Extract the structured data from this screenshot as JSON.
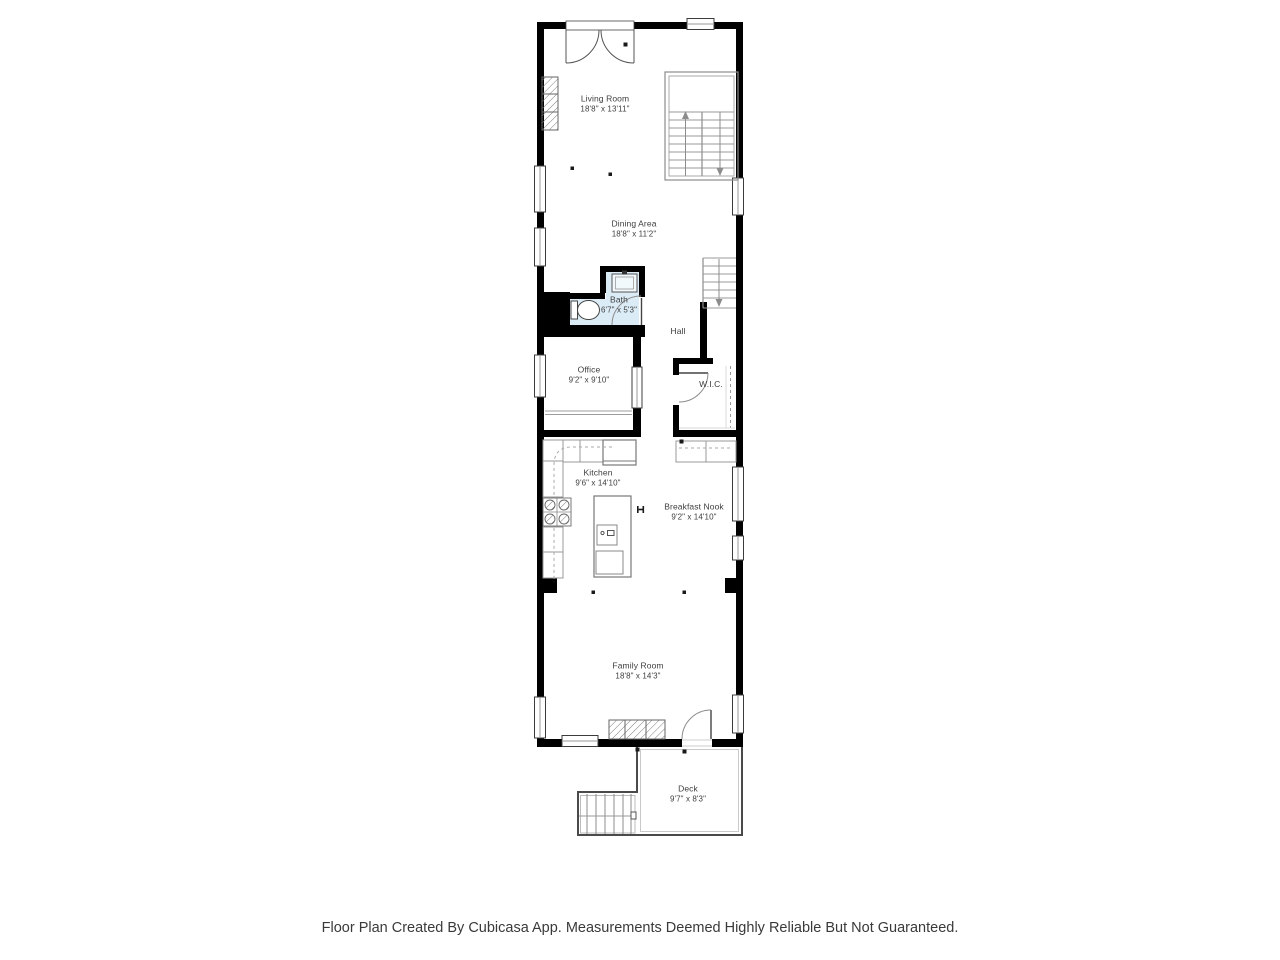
{
  "footer": {
    "text": "Floor Plan Created By Cubicasa App. Measurements Deemed Highly Reliable But Not Guaranteed."
  },
  "rooms": [
    {
      "name": "Living Room",
      "dims": "18'8\" x 13'11\""
    },
    {
      "name": "Dining Area",
      "dims": "18'8\" x 11'2\""
    },
    {
      "name": "Bath",
      "dims": "6'7\" x 5'3\""
    },
    {
      "name": "Hall",
      "dims": ""
    },
    {
      "name": "Office",
      "dims": "9'2\" x 9'10\""
    },
    {
      "name": "W.I.C.",
      "dims": ""
    },
    {
      "name": "Kitchen",
      "dims": "9'6\" x 14'10\""
    },
    {
      "name": "Breakfast Nook",
      "dims": "9'2\" x 14'10\""
    },
    {
      "name": "Family Room",
      "dims": "18'8\" x 14'3\""
    },
    {
      "name": "Deck",
      "dims": "9'7\" x 8'3\""
    }
  ],
  "colors": {
    "wall": "#000000",
    "bath_fill": "#dcecf7",
    "line": "#8c8c8c",
    "text": "#3d3d3d",
    "background": "#ffffff"
  },
  "fixtures": [
    "main-staircase",
    "hall-staircase",
    "deck-stairs",
    "french-entry-door",
    "fireplace-living",
    "fireplace-family",
    "bath-sink",
    "toilet",
    "stove-cooktop",
    "kitchen-island",
    "island-sink",
    "dishwasher",
    "refrigerator",
    "stairs-up-arrow",
    "stairs-down-arrow",
    "bath-door",
    "wic-door",
    "deck-door",
    "wic-closet-rod"
  ]
}
